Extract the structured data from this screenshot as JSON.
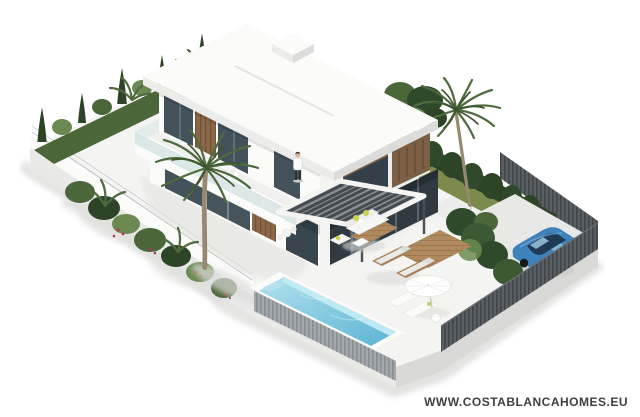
{
  "image": {
    "watermark": "WWW.COSTABLANCAHOMES.EU",
    "type": "isometric 3D architectural render",
    "subject": "modern two-storey white villa with garden, pool, sun terrace and parking"
  },
  "scene": {
    "building": "white cubic villa with wood cladding, glass facades, cantilevered terrace with glass balustrade and slatted pergola",
    "person": "man standing on first-floor terrace",
    "pool": "rectangular swimming pool with light blue water and grey slatted overflow side",
    "car": "blue car parked on driveway behind hedge",
    "fences": [
      "white rendered wall with wire fence on left boundary",
      "dark grey slatted fence on right boundary"
    ],
    "vegetation": [
      "cypress hedge row",
      "tall back palm tree",
      "front palm tree",
      "leafy tree",
      "tropical shrubs with red flowers",
      "dark boundary hedge",
      "car-side hedge"
    ],
    "furniture": [
      "outdoor sofa with yellow pillows",
      "two wooden sun loungers on deck pads",
      "two white poolside loungers",
      "white parasol",
      "round side table",
      "terrace sofa",
      "dining set"
    ]
  },
  "palette": {
    "background": "#ffffff",
    "paving": "#f4f4f2",
    "plinth_light": "#e9e9e7",
    "plinth_shadow": "#d9d9d7",
    "wall_white": "#fbfbfa",
    "fascia_light": "#ececea",
    "fascia_dark": "#dcdcda",
    "glass": "#42515a",
    "glass_deep": "#2f3a41",
    "balustrade_glass": "#cfe3e3",
    "wood": "#8a6747",
    "wood_dark": "#6f5238",
    "grass": "#7c8a4d",
    "green_dark": "#2e4426",
    "green_mid": "#4b6638",
    "green_light": "#6b8a52",
    "hedge": "#2f4a2b",
    "fence_dark": "#5a5f63",
    "fence_light": "#a2a8ac",
    "water_light": "#b2e2ee",
    "water_deep": "#5ab4d4",
    "car_blue": "#3e82bc",
    "flower_red": "#b0394a",
    "flower_magenta": "#a03a70",
    "pillow_yellow": "#c8d24a",
    "palm_frond": "#4f6b3d",
    "palm_frond_dark": "#3c5530",
    "trunk": "#97886f",
    "watermark_text": "#3f3f3f"
  }
}
